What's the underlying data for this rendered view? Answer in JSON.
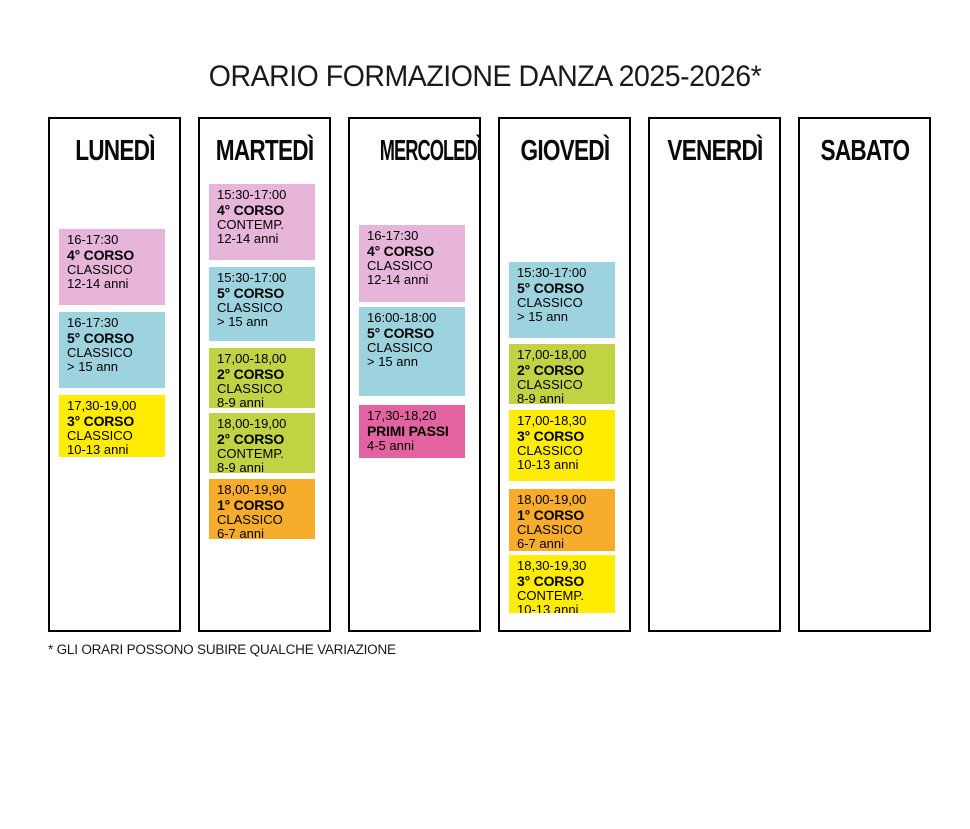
{
  "title": "ORARIO FORMAZIONE DANZA 2025-2026*",
  "footnote": "* GLI ORARI POSSONO SUBIRE QUALCHE VARIAZIONE",
  "colors": {
    "pink": "#e6b5d9",
    "blue": "#9cd3de",
    "yellow": "#ffec00",
    "green": "#c1d342",
    "orange": "#f8ac2b",
    "magenta": "#e2639f"
  },
  "days": [
    {
      "label": "LUNEDÌ",
      "events": [
        {
          "time": "16-17:30",
          "course": "4° CORSO",
          "discipline": "CLASSICO",
          "ages": "12-14 anni",
          "color": "pink",
          "top": 110,
          "height": 76
        },
        {
          "time": "16-17:30",
          "course": "5° CORSO",
          "discipline": "CLASSICO",
          "ages": "> 15 ann",
          "color": "blue",
          "top": 193,
          "height": 76
        },
        {
          "time": "17,30-19,00",
          "course": "3° CORSO",
          "discipline": "CLASSICO",
          "ages": "10-13 anni",
          "color": "yellow",
          "top": 276,
          "height": 62
        }
      ]
    },
    {
      "label": "MARTEDÌ",
      "events": [
        {
          "time": "15:30-17:00",
          "course": "4° CORSO",
          "discipline": "CONTEMP.",
          "ages": "12-14 anni",
          "color": "pink",
          "top": 65,
          "height": 76
        },
        {
          "time": "15:30-17:00",
          "course": "5° CORSO",
          "discipline": "CLASSICO",
          "ages": "> 15 ann",
          "color": "blue",
          "top": 148,
          "height": 74
        },
        {
          "time": "17,00-18,00",
          "course": "2° CORSO",
          "discipline": "CLASSICO",
          "ages": "8-9 anni",
          "color": "green",
          "top": 229,
          "height": 60
        },
        {
          "time": "18,00-19,00",
          "course": "2° CORSO",
          "discipline": "CONTEMP.",
          "ages": "8-9 anni",
          "color": "green",
          "top": 294,
          "height": 60
        },
        {
          "time": "18,00-19,90",
          "course": "1° CORSO",
          "discipline": "CLASSICO",
          "ages": "6-7 anni",
          "color": "orange",
          "top": 360,
          "height": 60
        }
      ]
    },
    {
      "label": "MERCOLEDÌ",
      "events": [
        {
          "time": "16-17:30",
          "course": "4° CORSO",
          "discipline": "CLASSICO",
          "ages": "12-14 anni",
          "color": "pink",
          "top": 106,
          "height": 77
        },
        {
          "time": "16:00-18:00",
          "course": "5° CORSO",
          "discipline": "CLASSICO",
          "ages": "> 15 ann",
          "color": "blue",
          "top": 188,
          "height": 89
        },
        {
          "time": "17,30-18,20",
          "course": "PRIMI PASSI",
          "discipline": "",
          "ages": "4-5 anni",
          "color": "magenta",
          "top": 286,
          "height": 53
        }
      ]
    },
    {
      "label": "GIOVEDÌ",
      "events": [
        {
          "time": "15:30-17:00",
          "course": "5° CORSO",
          "discipline": "CLASSICO",
          "ages": "> 15 ann",
          "color": "blue",
          "top": 143,
          "height": 76
        },
        {
          "time": "17,00-18,00",
          "course": "2° CORSO",
          "discipline": "CLASSICO",
          "ages": "8-9 anni",
          "color": "green",
          "top": 225,
          "height": 60
        },
        {
          "time": "17,00-18,30",
          "course": "3° CORSO",
          "discipline": "CLASSICO",
          "ages": "10-13 anni",
          "color": "yellow",
          "top": 291,
          "height": 71
        },
        {
          "time": "18,00-19,00",
          "course": "1° CORSO",
          "discipline": "CLASSICO",
          "ages": "6-7 anni",
          "color": "orange",
          "top": 370,
          "height": 62
        },
        {
          "time": "18,30-19,30",
          "course": "3° CORSO",
          "discipline": "CONTEMP.",
          "ages": "10-13 anni",
          "color": "yellow",
          "top": 436,
          "height": 58
        }
      ]
    },
    {
      "label": "VENERDÌ",
      "events": []
    },
    {
      "label": "SABATO",
      "events": []
    }
  ]
}
